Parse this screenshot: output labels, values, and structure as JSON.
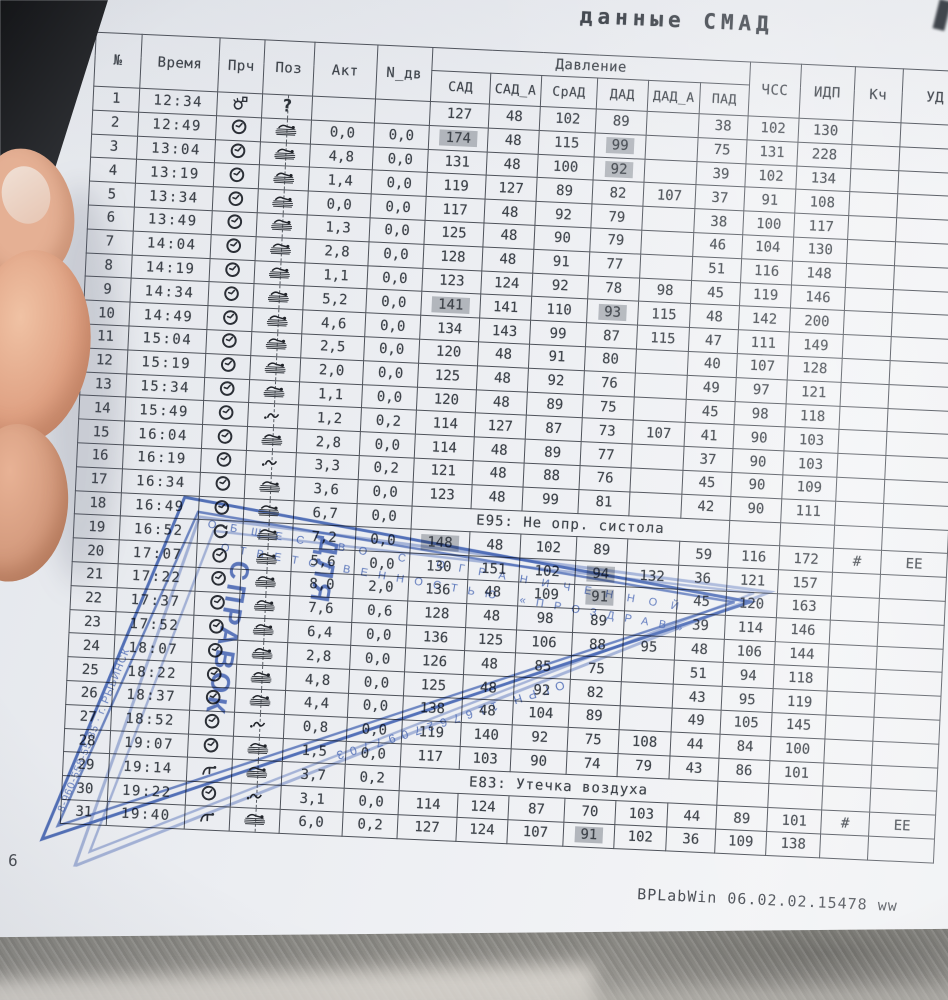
{
  "title": "данные СМАД",
  "footer": {
    "page_number": "6",
    "app_version": "BPLabWin 06.02.02.15478  ww"
  },
  "colors": {
    "paper": "#edeff2",
    "ink": "#3e434a",
    "cell_shade": "#b2b6bc",
    "stamp_blue": "#2f55b2",
    "fabric_grey": "#8f8d88"
  },
  "icons": {
    "clock": "clock-icon",
    "retry": "retry-arrow-icon",
    "manual": "hand-press-icon",
    "start": "bulb-marker-icon",
    "lying": "lying-position-icon",
    "moving": "movement-squiggle-icon",
    "unknown": "question-mark"
  },
  "stamp": {
    "company_line1": "ОБЩЕСТВО С ОГРАНИЧЕННОЙ",
    "company_line2": "ОТВЕТСТВЕННОСТЬЮ «ПРОЗДРАВ»",
    "center_line1": "ДЛЯ",
    "center_line2": "СПРАВОК",
    "ogrn": "ОГРН 1167627097703",
    "left_edge": "8-960-558-55-85 · г. РЫБИНСК"
  },
  "table": {
    "left_columns": [
      "№",
      "Время",
      "Прч",
      "Поз",
      "Акт",
      "N_дв"
    ],
    "group_header": "Давление",
    "pressure_columns": [
      "САД",
      "САД_А",
      "СрАД",
      "ДАД",
      "ДАД_А",
      "ПАД"
    ],
    "right_columns": [
      "ЧСС",
      "ИДП",
      "Кч",
      "УД"
    ],
    "rows": [
      {
        "n": "1",
        "time": "12:34",
        "reason": "start",
        "pos": "unknown",
        "akt": "",
        "ndv": "",
        "sad": "127",
        "sad_a": "48",
        "srad": "102",
        "dad": "89",
        "dad_a": "",
        "pad": "38",
        "chss": "102",
        "idp": "130",
        "hl": []
      },
      {
        "n": "2",
        "time": "12:49",
        "reason": "clock",
        "pos": "lying",
        "akt": "0,0",
        "ndv": "0,0",
        "sad": "174",
        "sad_a": "48",
        "srad": "115",
        "dad": "99",
        "dad_a": "",
        "pad": "75",
        "chss": "131",
        "idp": "228",
        "hl": [
          "sad",
          "dad"
        ]
      },
      {
        "n": "3",
        "time": "13:04",
        "reason": "clock",
        "pos": "lying",
        "akt": "4,8",
        "ndv": "0,0",
        "sad": "131",
        "sad_a": "48",
        "srad": "100",
        "dad": "92",
        "dad_a": "",
        "pad": "39",
        "chss": "102",
        "idp": "134",
        "hl": [
          "dad"
        ]
      },
      {
        "n": "4",
        "time": "13:19",
        "reason": "clock",
        "pos": "lying",
        "akt": "1,4",
        "ndv": "0,0",
        "sad": "119",
        "sad_a": "127",
        "srad": "89",
        "dad": "82",
        "dad_a": "107",
        "pad": "37",
        "chss": "91",
        "idp": "108",
        "hl": []
      },
      {
        "n": "5",
        "time": "13:34",
        "reason": "clock",
        "pos": "lying",
        "akt": "0,0",
        "ndv": "0,0",
        "sad": "117",
        "sad_a": "48",
        "srad": "92",
        "dad": "79",
        "dad_a": "",
        "pad": "38",
        "chss": "100",
        "idp": "117",
        "hl": []
      },
      {
        "n": "6",
        "time": "13:49",
        "reason": "clock",
        "pos": "lying",
        "akt": "1,3",
        "ndv": "0,0",
        "sad": "125",
        "sad_a": "48",
        "srad": "90",
        "dad": "79",
        "dad_a": "",
        "pad": "46",
        "chss": "104",
        "idp": "130",
        "hl": []
      },
      {
        "n": "7",
        "time": "14:04",
        "reason": "clock",
        "pos": "lying",
        "akt": "2,8",
        "ndv": "0,0",
        "sad": "128",
        "sad_a": "48",
        "srad": "91",
        "dad": "77",
        "dad_a": "",
        "pad": "51",
        "chss": "116",
        "idp": "148",
        "hl": []
      },
      {
        "n": "8",
        "time": "14:19",
        "reason": "clock",
        "pos": "lying",
        "akt": "1,1",
        "ndv": "0,0",
        "sad": "123",
        "sad_a": "124",
        "srad": "92",
        "dad": "78",
        "dad_a": "98",
        "pad": "45",
        "chss": "119",
        "idp": "146",
        "hl": []
      },
      {
        "n": "9",
        "time": "14:34",
        "reason": "clock",
        "pos": "lying",
        "akt": "5,2",
        "ndv": "0,0",
        "sad": "141",
        "sad_a": "141",
        "srad": "110",
        "dad": "93",
        "dad_a": "115",
        "pad": "48",
        "chss": "142",
        "idp": "200",
        "hl": [
          "sad",
          "dad"
        ]
      },
      {
        "n": "10",
        "time": "14:49",
        "reason": "clock",
        "pos": "lying",
        "akt": "4,6",
        "ndv": "0,0",
        "sad": "134",
        "sad_a": "143",
        "srad": "99",
        "dad": "87",
        "dad_a": "115",
        "pad": "47",
        "chss": "111",
        "idp": "149",
        "hl": []
      },
      {
        "n": "11",
        "time": "15:04",
        "reason": "clock",
        "pos": "lying",
        "akt": "2,5",
        "ndv": "0,0",
        "sad": "120",
        "sad_a": "48",
        "srad": "91",
        "dad": "80",
        "dad_a": "",
        "pad": "40",
        "chss": "107",
        "idp": "128",
        "hl": []
      },
      {
        "n": "12",
        "time": "15:19",
        "reason": "clock",
        "pos": "lying",
        "akt": "2,0",
        "ndv": "0,0",
        "sad": "125",
        "sad_a": "48",
        "srad": "92",
        "dad": "76",
        "dad_a": "",
        "pad": "49",
        "chss": "97",
        "idp": "121",
        "hl": []
      },
      {
        "n": "13",
        "time": "15:34",
        "reason": "clock",
        "pos": "lying",
        "akt": "1,1",
        "ndv": "0,0",
        "sad": "120",
        "sad_a": "48",
        "srad": "89",
        "dad": "75",
        "dad_a": "",
        "pad": "45",
        "chss": "98",
        "idp": "118",
        "hl": []
      },
      {
        "n": "14",
        "time": "15:49",
        "reason": "clock",
        "pos": "moving",
        "akt": "1,2",
        "ndv": "0,2",
        "sad": "114",
        "sad_a": "127",
        "srad": "87",
        "dad": "73",
        "dad_a": "107",
        "pad": "41",
        "chss": "90",
        "idp": "103",
        "hl": []
      },
      {
        "n": "15",
        "time": "16:04",
        "reason": "clock",
        "pos": "lying",
        "akt": "2,8",
        "ndv": "0,0",
        "sad": "114",
        "sad_a": "48",
        "srad": "89",
        "dad": "77",
        "dad_a": "",
        "pad": "37",
        "chss": "90",
        "idp": "103",
        "hl": []
      },
      {
        "n": "16",
        "time": "16:19",
        "reason": "clock",
        "pos": "moving",
        "akt": "3,3",
        "ndv": "0,2",
        "sad": "121",
        "sad_a": "48",
        "srad": "88",
        "dad": "76",
        "dad_a": "",
        "pad": "45",
        "chss": "90",
        "idp": "109",
        "hl": []
      },
      {
        "n": "17",
        "time": "16:34",
        "reason": "clock",
        "pos": "lying",
        "akt": "3,6",
        "ndv": "0,0",
        "sad": "123",
        "sad_a": "48",
        "srad": "99",
        "dad": "81",
        "dad_a": "",
        "pad": "42",
        "chss": "90",
        "idp": "111",
        "hl": []
      },
      {
        "n": "18",
        "time": "16:49",
        "reason": "clock",
        "pos": "lying",
        "akt": "6,7",
        "ndv": "0,0",
        "error": "E95: Не опр. систола"
      },
      {
        "n": "19",
        "time": "16:52",
        "reason": "retry",
        "pos": "lying",
        "akt": "7,2",
        "ndv": "0,0",
        "sad": "148",
        "sad_a": "48",
        "srad": "102",
        "dad": "89",
        "dad_a": "",
        "pad": "59",
        "chss": "116",
        "idp": "172",
        "kch": "#",
        "ud": "ЕЕ",
        "hl": [
          "sad"
        ]
      },
      {
        "n": "20",
        "time": "17:07",
        "reason": "clock",
        "pos": "lying",
        "akt": "5,6",
        "ndv": "0,0",
        "sad": "130",
        "sad_a": "151",
        "srad": "102",
        "dad": "94",
        "dad_a": "132",
        "pad": "36",
        "chss": "121",
        "idp": "157",
        "hl": [
          "dad"
        ]
      },
      {
        "n": "21",
        "time": "17:22",
        "reason": "clock",
        "pos": "lying",
        "akt": "8,0",
        "ndv": "2,0",
        "sad": "136",
        "sad_a": "48",
        "srad": "109",
        "dad": "91",
        "dad_a": "",
        "pad": "45",
        "chss": "120",
        "idp": "163",
        "hl": [
          "dad"
        ]
      },
      {
        "n": "22",
        "time": "17:37",
        "reason": "clock",
        "pos": "lying",
        "akt": "7,6",
        "ndv": "0,6",
        "sad": "128",
        "sad_a": "48",
        "srad": "98",
        "dad": "89",
        "dad_a": "",
        "pad": "39",
        "chss": "114",
        "idp": "146",
        "hl": []
      },
      {
        "n": "23",
        "time": "17:52",
        "reason": "clock",
        "pos": "lying",
        "akt": "6,4",
        "ndv": "0,0",
        "sad": "136",
        "sad_a": "125",
        "srad": "106",
        "dad": "88",
        "dad_a": "95",
        "pad": "48",
        "chss": "106",
        "idp": "144",
        "hl": []
      },
      {
        "n": "24",
        "time": "18:07",
        "reason": "clock",
        "pos": "lying",
        "akt": "2,8",
        "ndv": "0,0",
        "sad": "126",
        "sad_a": "48",
        "srad": "85",
        "dad": "75",
        "dad_a": "",
        "pad": "51",
        "chss": "94",
        "idp": "118",
        "hl": []
      },
      {
        "n": "25",
        "time": "18:22",
        "reason": "clock",
        "pos": "lying",
        "akt": "4,8",
        "ndv": "0,0",
        "sad": "125",
        "sad_a": "48",
        "srad": "92",
        "dad": "82",
        "dad_a": "",
        "pad": "43",
        "chss": "95",
        "idp": "119",
        "hl": []
      },
      {
        "n": "26",
        "time": "18:37",
        "reason": "clock",
        "pos": "lying",
        "akt": "4,4",
        "ndv": "0,0",
        "sad": "138",
        "sad_a": "48",
        "srad": "104",
        "dad": "89",
        "dad_a": "",
        "pad": "49",
        "chss": "105",
        "idp": "145",
        "hl": []
      },
      {
        "n": "27",
        "time": "18:52",
        "reason": "clock",
        "pos": "moving",
        "akt": "0,8",
        "ndv": "0,0",
        "sad": "119",
        "sad_a": "140",
        "srad": "92",
        "dad": "75",
        "dad_a": "108",
        "pad": "44",
        "chss": "84",
        "idp": "100",
        "hl": []
      },
      {
        "n": "28",
        "time": "19:07",
        "reason": "clock",
        "pos": "lying",
        "akt": "1,5",
        "ndv": "0,0",
        "sad": "117",
        "sad_a": "103",
        "srad": "90",
        "dad": "74",
        "dad_a": "79",
        "pad": "43",
        "chss": "86",
        "idp": "101",
        "hl": []
      },
      {
        "n": "29",
        "time": "19:14",
        "reason": "manual",
        "pos": "lying",
        "akt": "3,7",
        "ndv": "0,2",
        "error": "E83: Утечка воздуха"
      },
      {
        "n": "30",
        "time": "19:22",
        "reason": "clock",
        "pos": "moving",
        "akt": "3,1",
        "ndv": "0,0",
        "sad": "114",
        "sad_a": "124",
        "srad": "87",
        "dad": "70",
        "dad_a": "103",
        "pad": "44",
        "chss": "89",
        "idp": "101",
        "kch": "#",
        "ud": "ЕЕ",
        "hl": []
      },
      {
        "n": "31",
        "time": "19:40",
        "reason": "manual",
        "pos": "lying",
        "akt": "6,0",
        "ndv": "0,2",
        "sad": "127",
        "sad_a": "124",
        "srad": "107",
        "dad": "91",
        "dad_a": "102",
        "pad": "36",
        "chss": "109",
        "idp": "138",
        "hl": [
          "dad"
        ]
      }
    ]
  }
}
